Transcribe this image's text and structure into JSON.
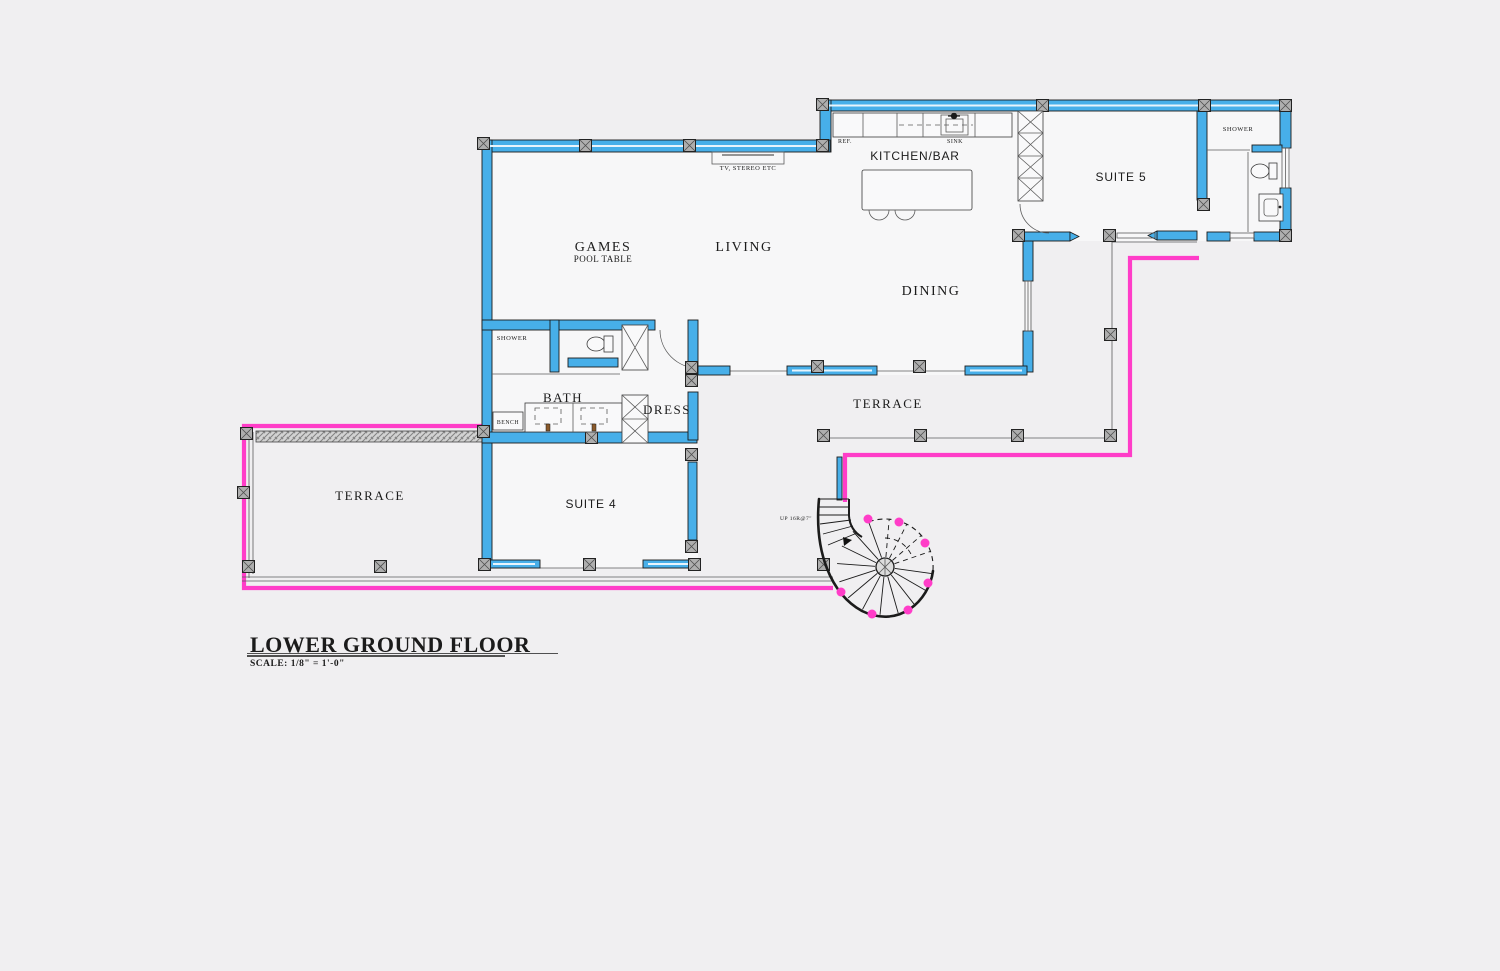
{
  "drawing": {
    "type": "architectural-floor-plan",
    "floor_name": "LOWER GROUND FLOOR",
    "scale_note": "SCALE: 1/8\" = 1'-0\""
  },
  "colors": {
    "background": "#f0eff1",
    "wall_blue": "#47afe9",
    "accent_pink": "#ff3dc8",
    "outline": "#1b1b1b",
    "thin_line": "#5c5c5c",
    "column_gray": "#aeaeae"
  },
  "rooms": {
    "games": {
      "label": "GAMES",
      "sublabel": "POOL TABLE"
    },
    "living": {
      "label": "LIVING"
    },
    "kitchen": {
      "label": "KITCHEN/BAR"
    },
    "dining": {
      "label": "DINING"
    },
    "suite5": {
      "label": "SUITE 5"
    },
    "suite4": {
      "label": "SUITE 4"
    },
    "terrace_left": {
      "label": "TERRACE"
    },
    "terrace_right": {
      "label": "TERRACE"
    },
    "bath": {
      "label": "BATH"
    },
    "dress": {
      "label": "DRESS"
    },
    "shower_bath": {
      "label": "SHOWER"
    },
    "shower_suite5": {
      "label": "SHOWER"
    },
    "bench": {
      "label": "BENCH"
    }
  },
  "fixtures": {
    "fridge": "REF.",
    "sink": "SINK",
    "tv_shelf": "TV, STEREO ETC"
  },
  "stair": {
    "note": "UP 16R@7\""
  }
}
